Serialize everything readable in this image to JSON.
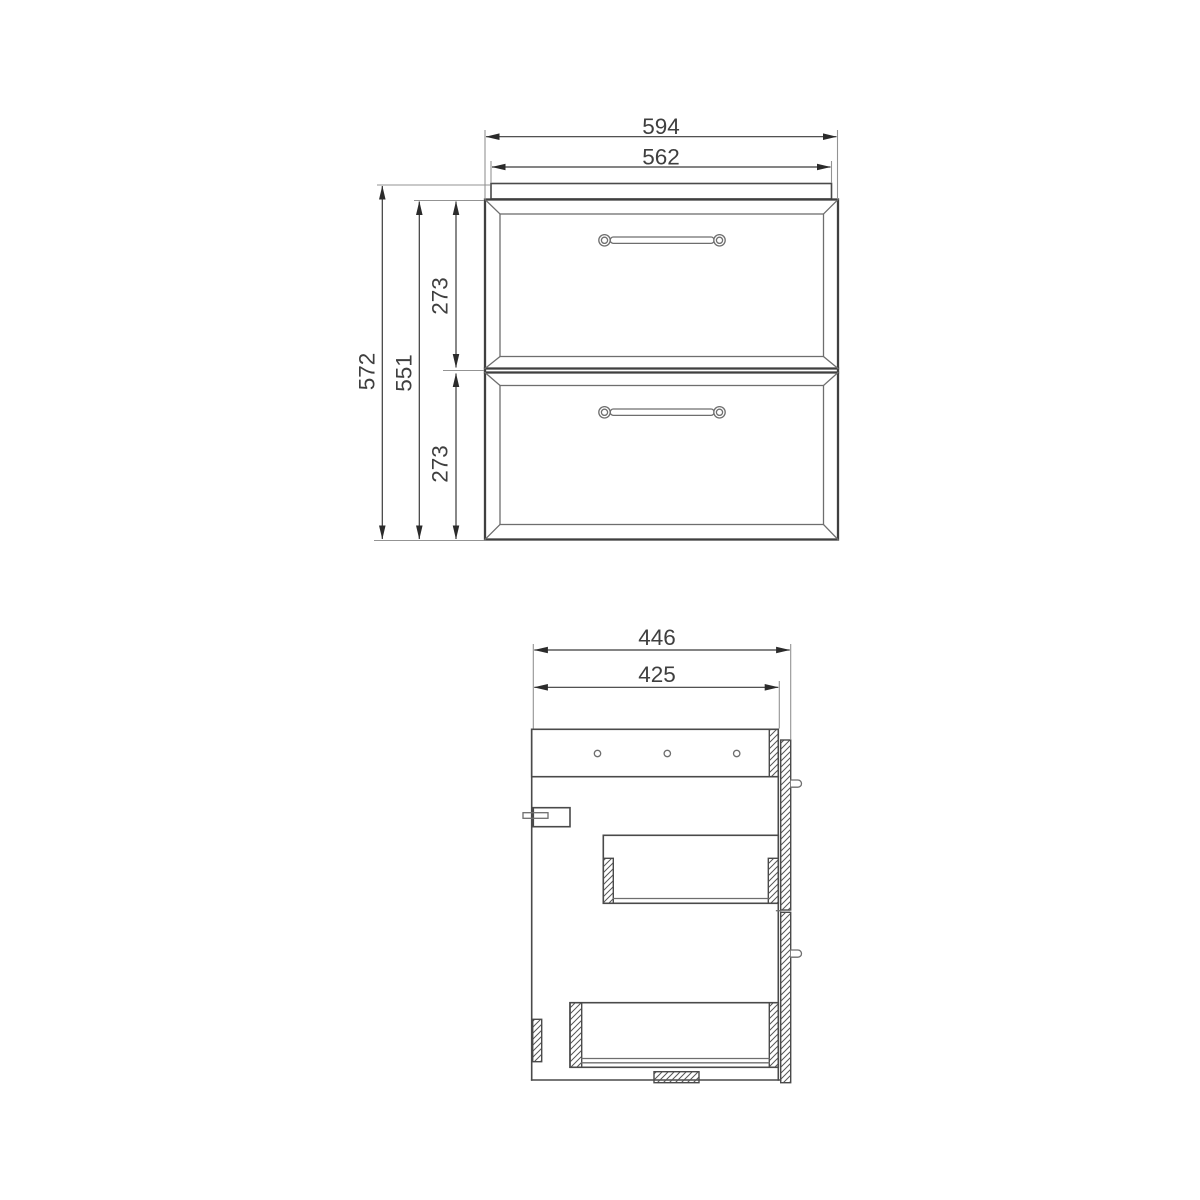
{
  "drawing": {
    "kind": "technical-dimension-drawing",
    "subject": "two-drawer cabinet, front and side views"
  },
  "colors": {
    "background": "#ffffff",
    "outline": "#4a4a4a",
    "thin_line": "#6e6e6e",
    "extension_line": "#939393",
    "dimension_line": "#3a3a3a",
    "arrow": "#2b2b2b",
    "text": "#3f3f3f"
  },
  "dims": {
    "front": {
      "overall_width": "594",
      "countertop_width": "562",
      "overall_height": "572",
      "cabinet_height": "551",
      "top_drawer_height": "273",
      "bottom_drawer_height": "273"
    },
    "side": {
      "overall_depth": "446",
      "carcass_depth": "425"
    }
  }
}
